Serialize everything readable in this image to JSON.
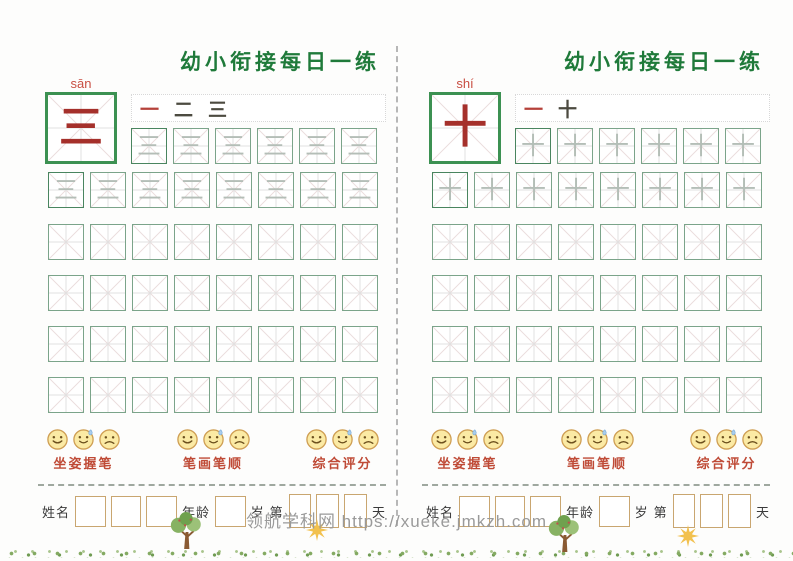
{
  "watermark": "领航学科网 https://xueke.jmkzh.com",
  "shared": {
    "ratings": [
      {
        "label": "坐姿握笔"
      },
      {
        "label": "笔画笔顺"
      },
      {
        "label": "综合评分"
      }
    ],
    "form": {
      "name_label": "姓名",
      "age_label": "年龄",
      "age_unit": "岁",
      "day_prefix": "第",
      "day_unit": "天"
    }
  },
  "pages": [
    {
      "title": "幼小衔接每日一练",
      "pinyin": "sān",
      "character": "三",
      "stroke_order": [
        "一",
        "二",
        "三"
      ],
      "grid": {
        "trace_row1": 6,
        "trace_row2": 8,
        "empty_rows": 4,
        "cols": 8
      }
    },
    {
      "title": "幼小衔接每日一练",
      "pinyin": "shí",
      "character": "十",
      "stroke_order": [
        "一",
        "十"
      ],
      "grid": {
        "trace_row1": 6,
        "trace_row2": 8,
        "empty_rows": 4,
        "cols": 8
      }
    }
  ],
  "colors": {
    "title_green": "#1f7a3a",
    "character_red": "#a5302b",
    "pinyin_red": "#c94f43",
    "big_box_border_green": "#3c9152",
    "practice_box_border_green": "#7ba48a",
    "rating_label_red": "#bf4a36",
    "form_box_border_tan": "#c9a670",
    "watermark_gray": "#9a9a9a",
    "emoji_yellow": "#fbeaa4"
  }
}
